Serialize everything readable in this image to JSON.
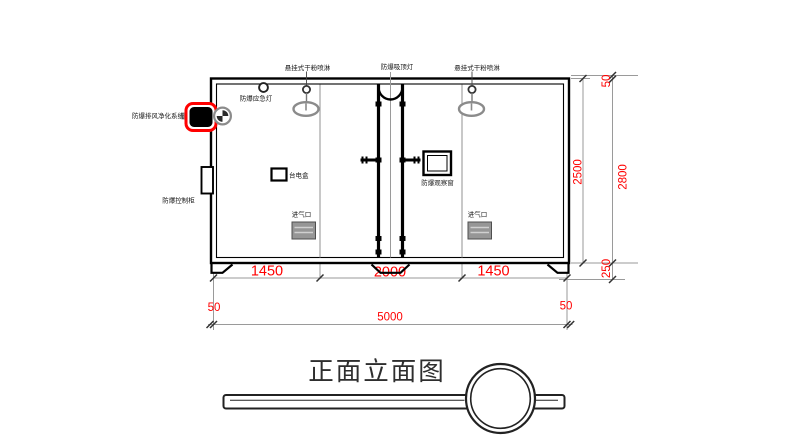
{
  "drawing": {
    "title": "正面立面图",
    "equipment": {
      "sprinkler_left": "悬挂式干粉喷淋",
      "ceiling_lamp": "防爆吸顶灯",
      "sprinkler_right": "悬挂式干粉喷淋",
      "emergency_light": "防爆应急灯",
      "exhaust_purifier": "防爆排风净化系统",
      "control_cabinet": "防爆控制柜",
      "junction_box": "台电盒",
      "observation_window": "防爆观察窗",
      "air_inlet_left": "进气口",
      "air_inlet_right": "进气口"
    },
    "dimensions": {
      "seg_left": "1450",
      "seg_mid": "2000",
      "seg_right": "1450",
      "wall_left": "50",
      "total_width": "5000",
      "wall_right": "50",
      "body_height": "2500",
      "roof_offset": "50",
      "total_height": "2800",
      "base_height": "250"
    },
    "colors": {
      "dimension_red": "#ff0000",
      "line_black": "#000000",
      "secondary_gray": "#8c8c8c"
    }
  }
}
